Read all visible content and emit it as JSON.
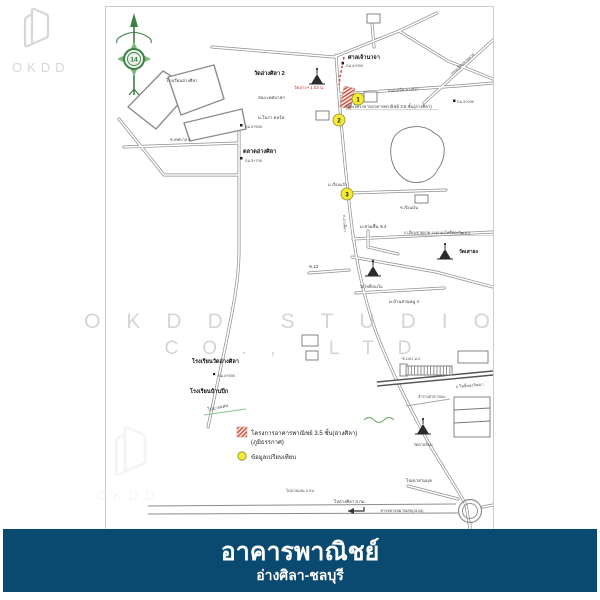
{
  "brand": {
    "logo_text": "OKDD"
  },
  "watermark": {
    "line1": "OKDD STUDIO",
    "line2": "CO., LTD"
  },
  "footer": {
    "title": "อาคารพาณิชย์",
    "subtitle": "อ่างศิลา-ชลบุรี",
    "bg_color": "#0a4a70",
    "text_color": "#ffffff"
  },
  "map": {
    "compass_label": "14",
    "colors": {
      "marker_fill": "#f4ec33",
      "project_red": "#c0392b",
      "road_gray": "#8d8d8d",
      "compass_green": "#3e7f46"
    },
    "markers": [
      {
        "label": "1"
      },
      {
        "label": "2"
      },
      {
        "label": "3"
      }
    ],
    "legend": {
      "project_line1": "โครงการอาคารพาณิชย์ 3.5 ชั้น(อ่างศิลา)",
      "project_line2": "(ภูมิธรรกาศ)",
      "compare_label": "ข้อมูลเปรียบเทียบ"
    },
    "labels": {
      "shrine": "ศาลเจ้านาจา",
      "km4000": "กม.4+000",
      "km3000": "กม.3+000",
      "km3500": "กม.3+500",
      "km3700": "กม.3+700",
      "km4500": "กม.4+500",
      "wat_angsila": "วัดอ่างศิลา 2",
      "red_note": "วัดอ่างฯ 1.03 น.",
      "site": "ที่ตั้งโครงการอาคารพาณิชย์ 3.5 ชั้น(อ่างศิลา)",
      "municipal": "สนง.เทศบาลฯ",
      "nora": "ม.โนรา คอร์ท",
      "school_top": "โรงเรียนอ่างศิลา",
      "market": "ตลาดอ่างศิลา",
      "soi_tessaban": "ซ.เทศบาล 8",
      "school_mid": "โรงเรียนวัดอ่างศิลา",
      "school_low": "โรงเรียนบ้านปึก",
      "to_bangsaen_side": "ไปบางแสน",
      "ruen_kaew": "ม.เรือนแก้ว",
      "chuanchuen": "ม.ชวนชื่น ซ.4",
      "ruen_ngoen": "ซ.เรือนเงิน",
      "beach_road14": "ถ.เลียบชายหาด 14(ถนนโพธิ์ทองวัฒนา)",
      "wat_saothong": "วัดเสาธง",
      "wat_photong": "วัดโพธิ์ทองใน",
      "soi13": "ซ.13",
      "baan_suan": "ม.บ้านสวนหมู่ 4",
      "soi14": "ซ.14/1 ม.2",
      "lamrang": "ลำรางสาธารณะ",
      "pho_wattana_rd": "ถ.โพธิ์ทองวัฒนา",
      "wat_tanlom": "วัดตาลล้อม",
      "to_sammuk": "ไปเขาสามมุข",
      "highway": "ทางหลวงหมายเลข(3134)",
      "to_angsila": "ไปอ่างศิลา 3 กม.",
      "to_bangsaen_bottom": "ไปบางแสน 4 กม.",
      "angsila_rd": "ถ.อ่างศิลา",
      "beach_rd_diag": "ถนนเลียบชายหาด",
      "semed_rd": "ถนนเสม็ด-อ่างศิลา"
    }
  }
}
